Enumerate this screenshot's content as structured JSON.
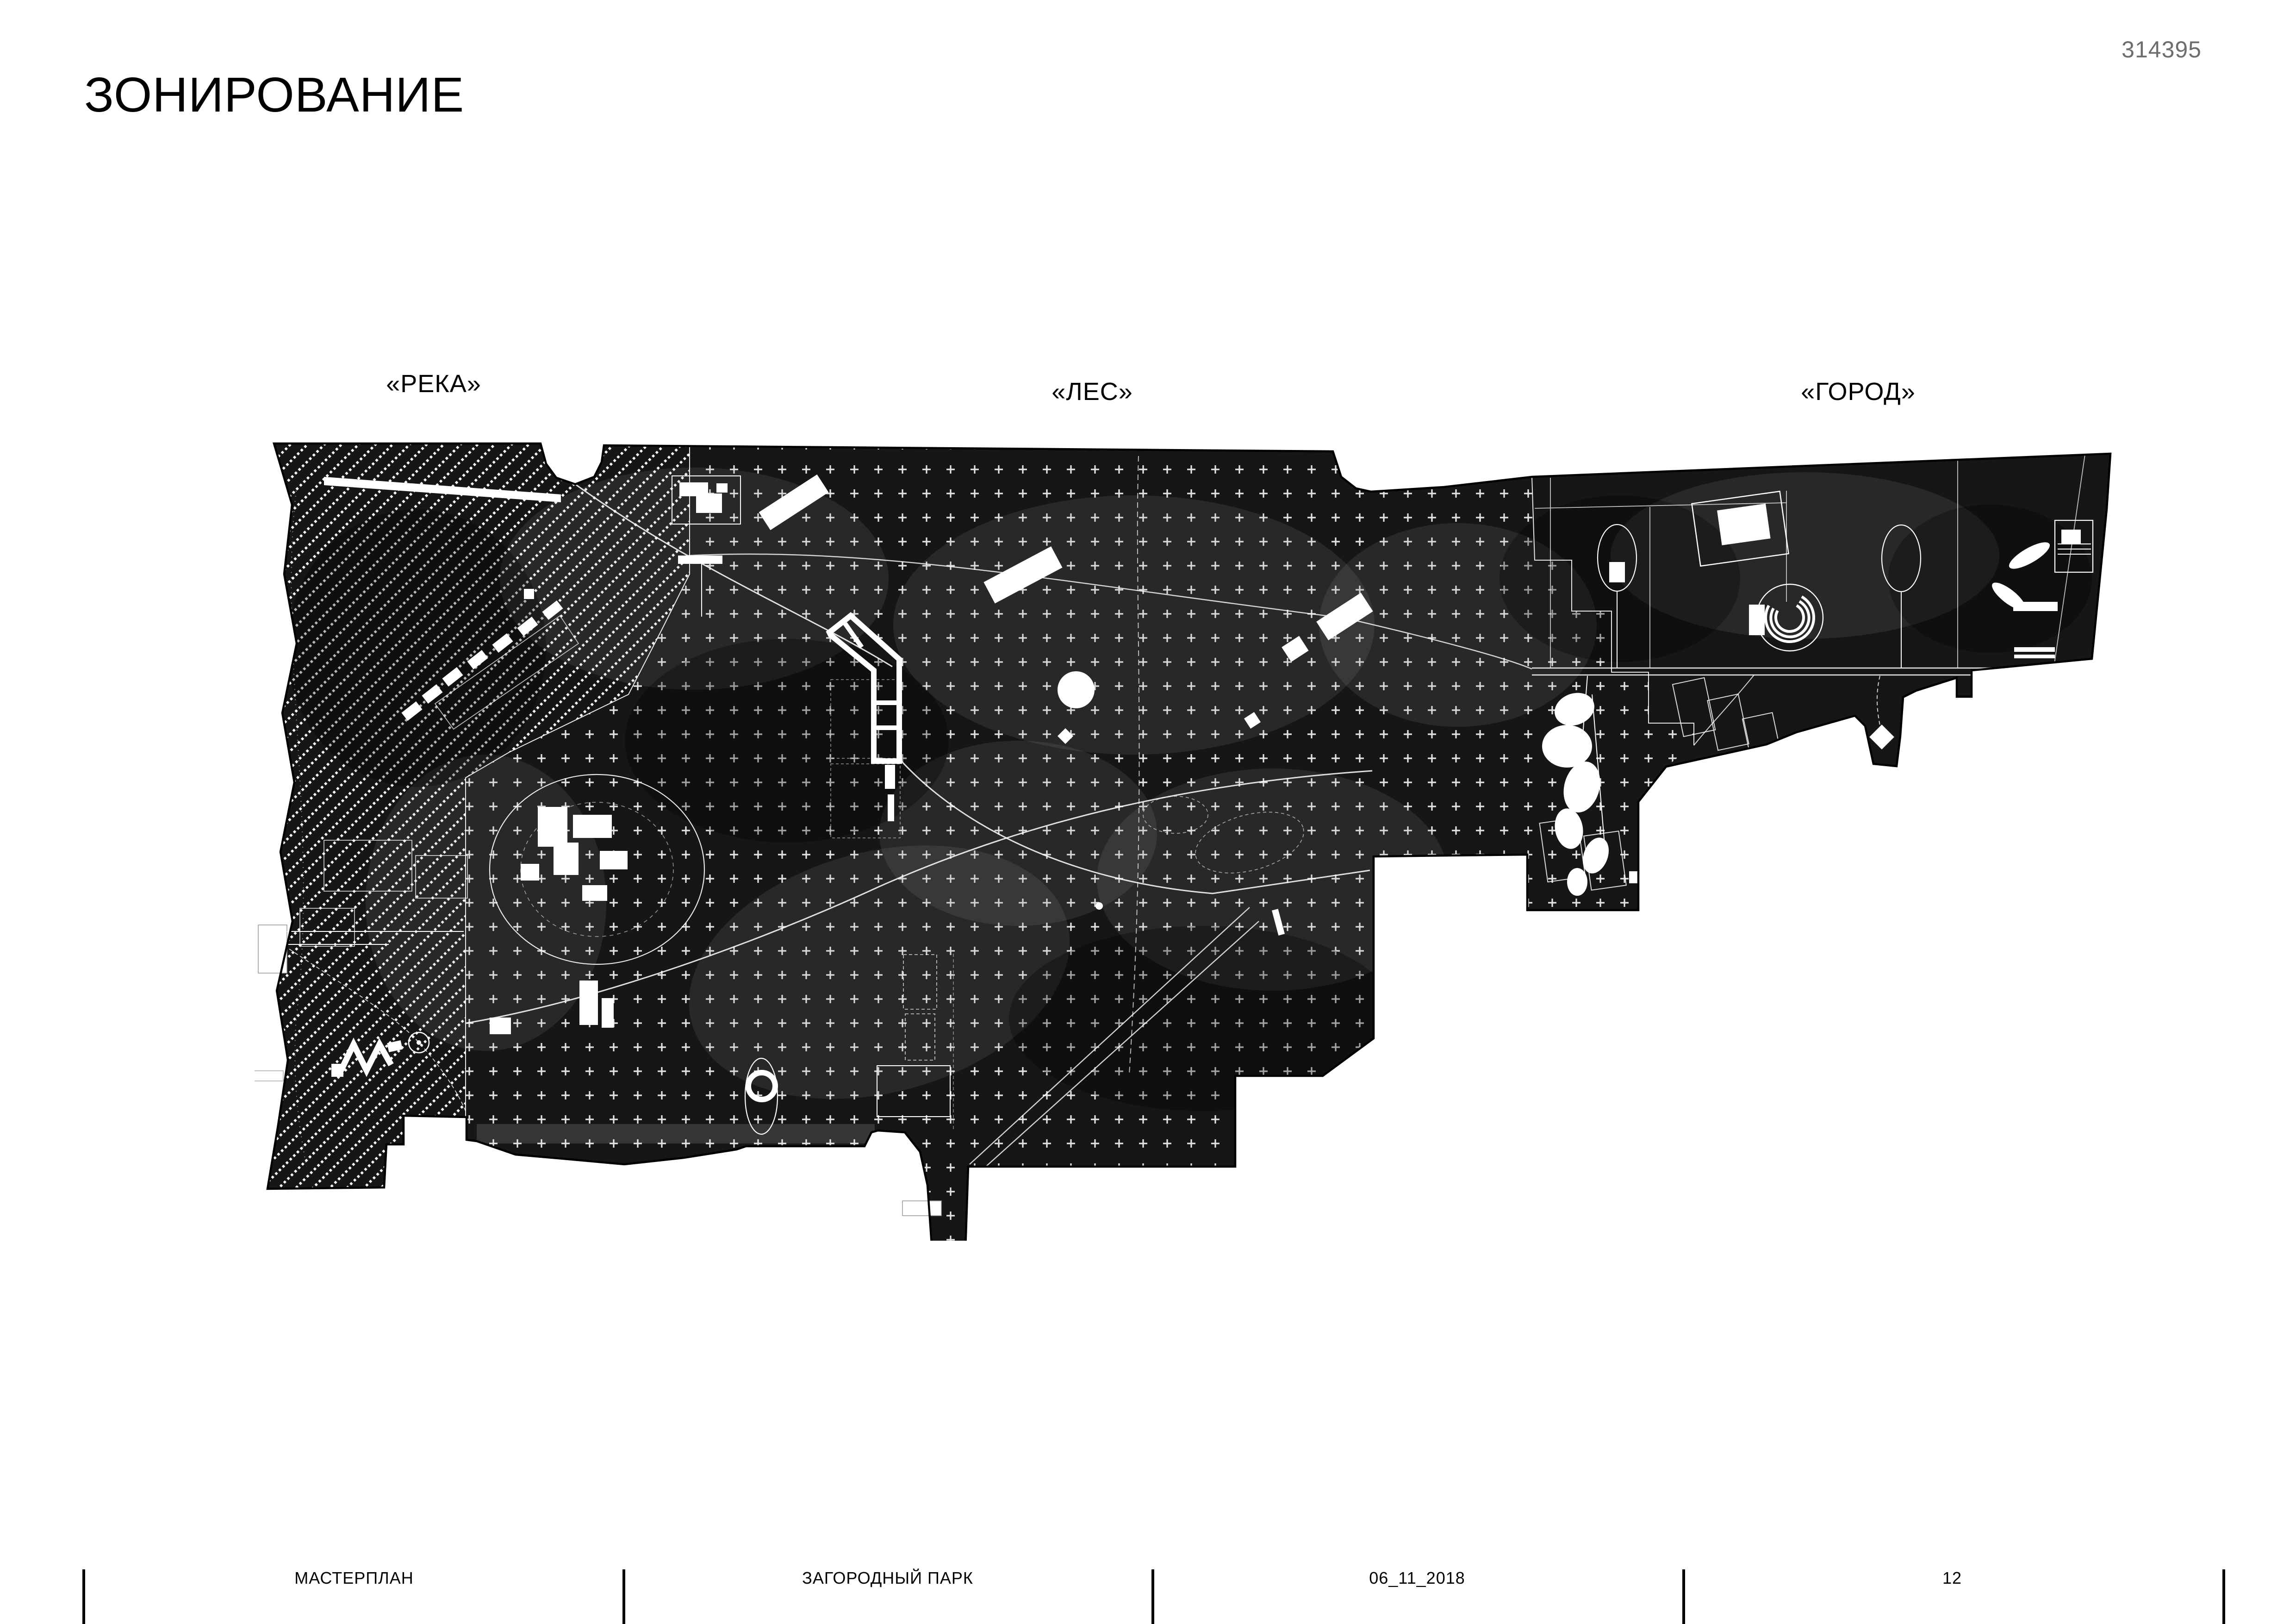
{
  "header": {
    "title": "ЗОНИРОВАНИЕ",
    "sheet_number": "314395",
    "sheet_number_color": "#6d6d6d"
  },
  "map": {
    "zone_labels": [
      {
        "id": "river",
        "label": "«РЕКА»"
      },
      {
        "id": "forest",
        "label": "«ЛЕС»"
      },
      {
        "id": "city",
        "label": "«ГОРОД»"
      }
    ],
    "legend": {
      "river_pattern": "diagonal-dotted-hatch",
      "forest_pattern": "plus-grid",
      "city_pattern": "dot-grid"
    },
    "colors": {
      "base": "#161616",
      "features": "#ffffff",
      "outline": "#000000"
    }
  },
  "footer": {
    "items": [
      {
        "label": "МАСТЕРПЛАН"
      },
      {
        "label": "ЗАГОРОДНЫЙ ПАРК"
      },
      {
        "label": "06_11_2018"
      },
      {
        "label": "12"
      }
    ]
  }
}
